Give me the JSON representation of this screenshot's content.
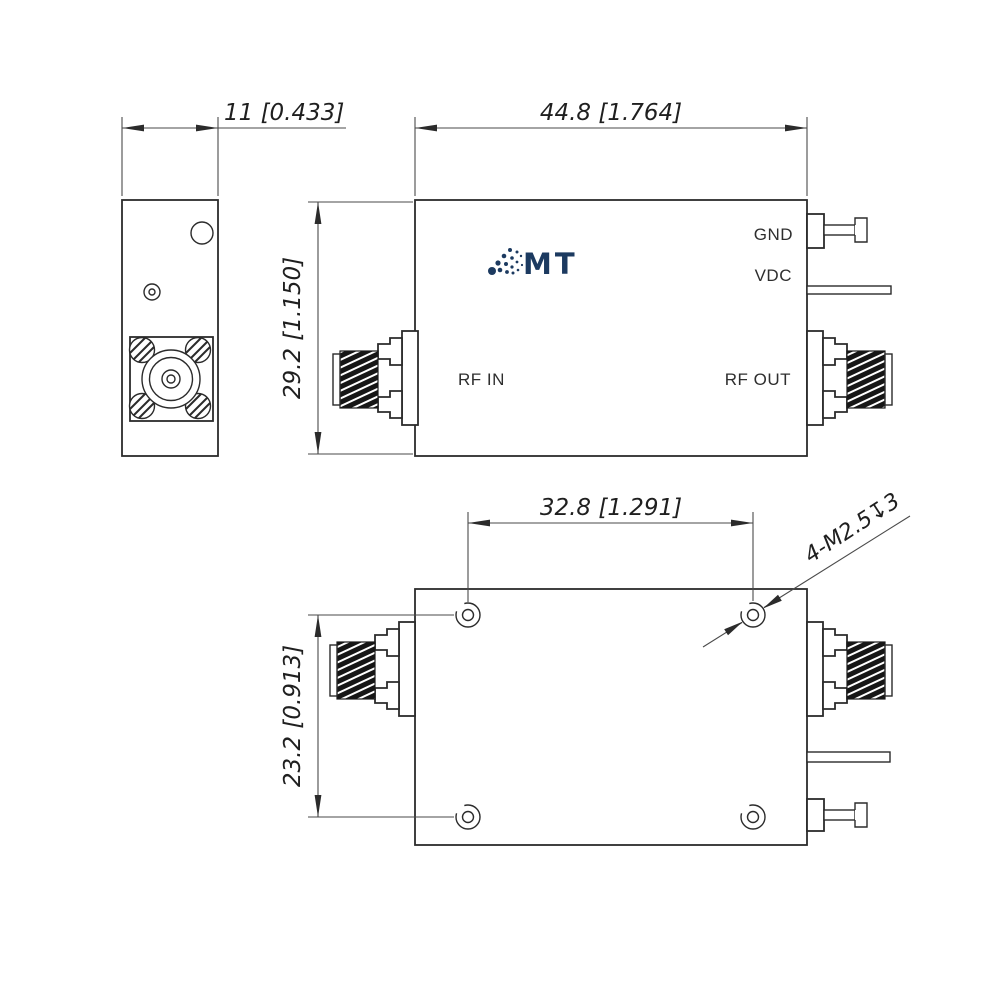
{
  "front_view": {
    "labels": {
      "gnd": "GND",
      "vdc": "VDC",
      "rf_in": "RF IN",
      "rf_out": "RF OUT"
    },
    "logo_text": "MT"
  },
  "dimensions": {
    "side_width": "11 [0.433]",
    "front_width": "44.8 [1.764]",
    "front_height": "29.2 [1.150]",
    "hole_spacing_horizontal": "32.8 [1.291]",
    "hole_spacing_vertical": "23.2 [0.913]",
    "mounting_holes_note": "4-M2.5↧3"
  },
  "colors": {
    "line": "#2b2b2b",
    "dim_line": "#4a4a4a",
    "logo_navy": "#1c3a60",
    "thread_fill": "#161616"
  }
}
